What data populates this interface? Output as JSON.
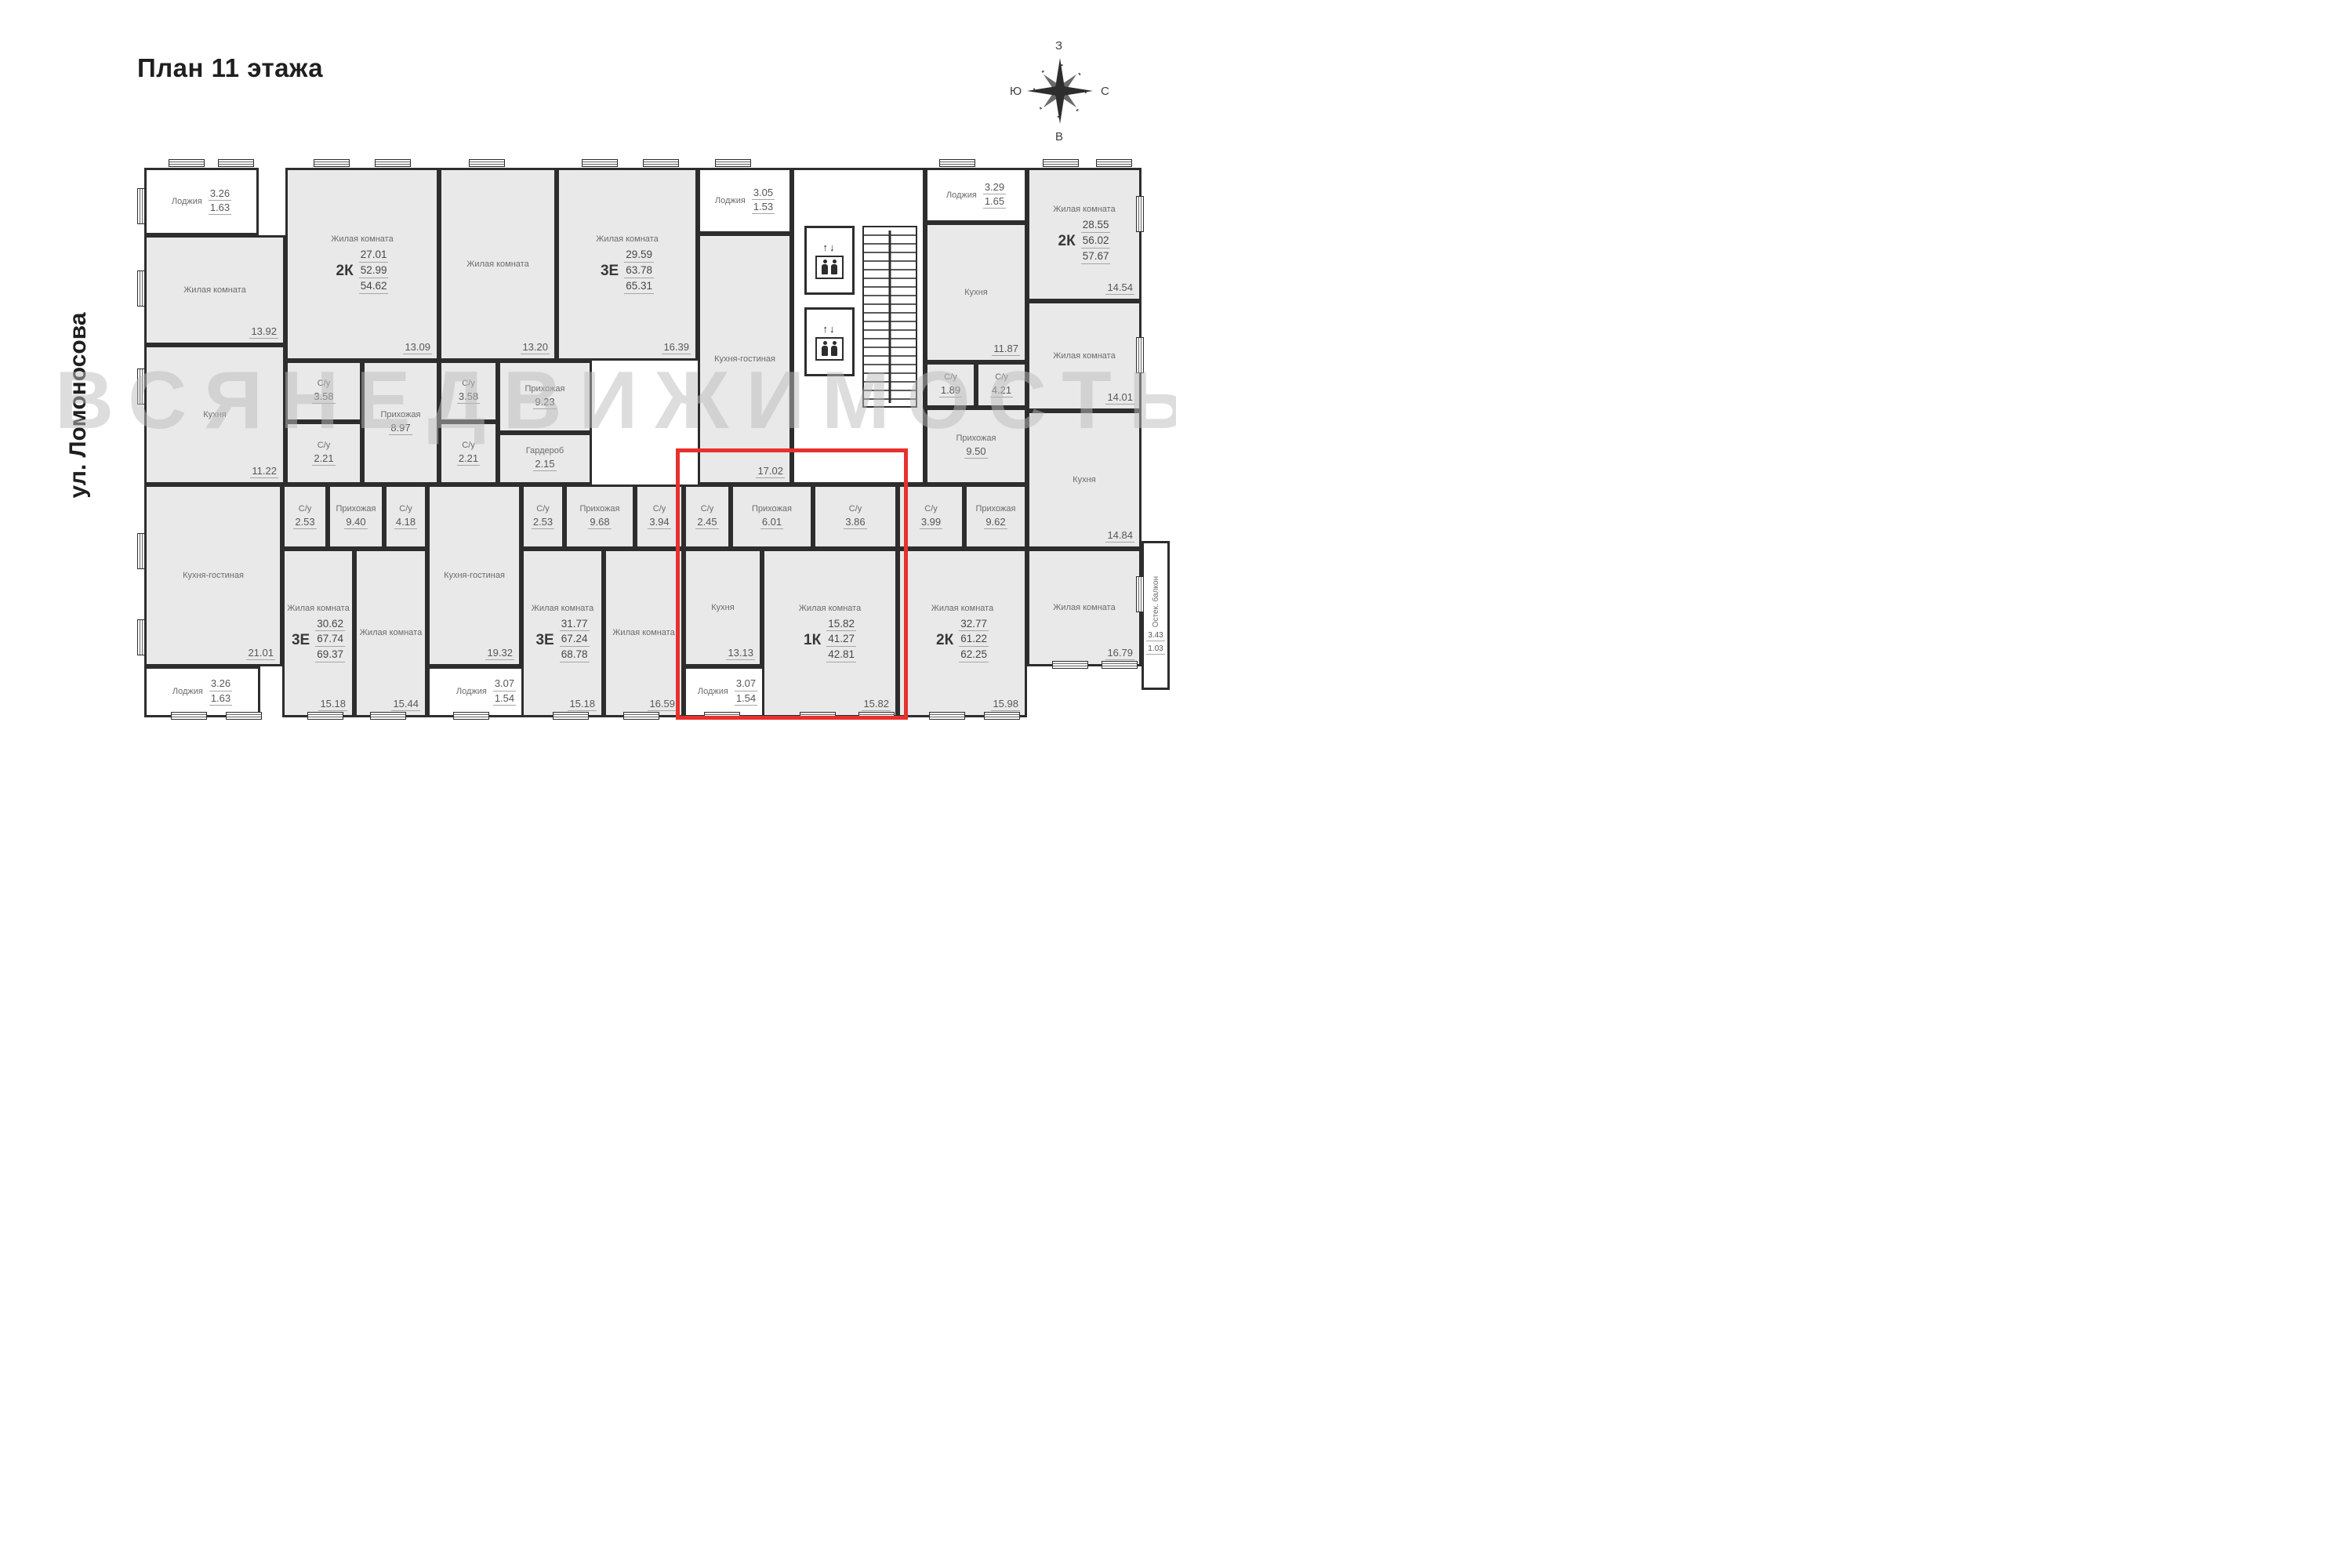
{
  "title": "План 11 этажа",
  "street": "ул. Ломоносова",
  "watermark": "ВСЯНЕДВИЖИМОСТЬ",
  "highlight_color": "#e8312e",
  "compass": {
    "top": "З",
    "right": "С",
    "bottom": "В",
    "left": "Ю"
  },
  "apartments": {
    "a": {
      "type": "2К",
      "living": "27.01",
      "area": "52.99",
      "total": "54.62",
      "rooms": {
        "loggia": {
          "name": "Лоджия",
          "a1": "3.26",
          "a2": "1.63"
        },
        "living1": {
          "name": "Жилая комната",
          "area": "13.92"
        },
        "kitchen": {
          "name": "Кухня",
          "area": "11.22"
        },
        "living2": {
          "name": "Жилая комната",
          "area": "13.09"
        },
        "bath1": {
          "name": "С/у",
          "area": "3.58"
        },
        "bath2": {
          "name": "С/у",
          "area": "2.21"
        },
        "hall": {
          "name": "Прихожая",
          "area": "8.97"
        }
      }
    },
    "b": {
      "type": "3Е",
      "living": "29.59",
      "area": "63.78",
      "total": "65.31",
      "rooms": {
        "living1": {
          "name": "Жилая комната",
          "area": "13.20"
        },
        "living2": {
          "name": "Жилая комната",
          "area": "16.39"
        },
        "bath1": {
          "name": "С/у",
          "area": "3.58"
        },
        "bath2": {
          "name": "С/у",
          "area": "2.21"
        },
        "hall": {
          "name": "Прихожая",
          "area": "9.23"
        },
        "wardrobe": {
          "name": "Гардероб",
          "area": "2.15"
        },
        "loggia": {
          "name": "Лоджия",
          "a1": "3.05",
          "a2": "1.53"
        },
        "kitchen": {
          "name": "Кухня-гостиная",
          "area": "17.02"
        }
      }
    },
    "d": {
      "type": "2К",
      "living": "28.55",
      "area": "56.02",
      "total": "57.67",
      "rooms": {
        "loggia": {
          "name": "Лоджия",
          "a1": "3.29",
          "a2": "1.65"
        },
        "kitchen": {
          "name": "Кухня",
          "area": "11.87"
        },
        "living1": {
          "name": "Жилая комната",
          "area": "14.54"
        },
        "living2": {
          "name": "Жилая комната",
          "area": "14.01"
        },
        "bath1": {
          "name": "С/у",
          "area": "1.89"
        },
        "bath2": {
          "name": "С/у",
          "area": "4.21"
        },
        "hall": {
          "name": "Прихожая",
          "area": "9.50"
        }
      }
    },
    "e": {
      "type": "3Е",
      "living": "30.62",
      "area": "67.74",
      "total": "69.37",
      "rooms": {
        "kitchen": {
          "name": "Кухня-гостиная",
          "area": "21.01"
        },
        "loggia": {
          "name": "Лоджия",
          "a1": "3.26",
          "a2": "1.63"
        },
        "bath1": {
          "name": "С/у",
          "area": "2.53"
        },
        "hall": {
          "name": "Прихожая",
          "area": "9.40"
        },
        "bath2": {
          "name": "С/у",
          "area": "4.18"
        },
        "living1": {
          "name": "Жилая комната",
          "area": "15.18"
        },
        "living2": {
          "name": "Жилая комната",
          "area": "15.44"
        }
      }
    },
    "f": {
      "type": "3Е",
      "living": "31.77",
      "area": "67.24",
      "total": "68.78",
      "rooms": {
        "kitchen": {
          "name": "Кухня-гостиная",
          "area": "19.32"
        },
        "loggia": {
          "name": "Лоджия",
          "a1": "3.07",
          "a2": "1.54"
        },
        "bath1": {
          "name": "С/у",
          "area": "2.53"
        },
        "hall": {
          "name": "Прихожая",
          "area": "9.68"
        },
        "bath2": {
          "name": "С/у",
          "area": "3.94"
        },
        "living1": {
          "name": "Жилая комната",
          "area": "15.18"
        },
        "living2": {
          "name": "Жилая комната",
          "area": "16.59"
        }
      }
    },
    "g": {
      "type": "1К",
      "living": "15.82",
      "area": "41.27",
      "total": "42.81",
      "highlighted": true,
      "rooms": {
        "bath1": {
          "name": "С/у",
          "area": "2.45"
        },
        "hall": {
          "name": "Прихожая",
          "area": "6.01"
        },
        "bath2": {
          "name": "С/у",
          "area": "3.86"
        },
        "kitchen": {
          "name": "Кухня",
          "area": "13.13"
        },
        "living1": {
          "name": "Жилая комната",
          "area": "15.82"
        },
        "loggia": {
          "name": "Лоджия",
          "a1": "3.07",
          "a2": "1.54"
        }
      }
    },
    "h": {
      "type": "2К",
      "living": "32.77",
      "area": "61.22",
      "total": "62.25",
      "rooms": {
        "hall": {
          "name": "Прихожая",
          "area": "9.62"
        },
        "bath1": {
          "name": "С/у",
          "area": "3.99"
        },
        "kitchen": {
          "name": "Кухня",
          "area": "14.84"
        },
        "living1": {
          "name": "Жилая комната",
          "area": "15.98"
        },
        "living2": {
          "name": "Жилая комната",
          "area": "16.79"
        },
        "balcony": {
          "name": "Остек. балкон",
          "a1": "3.43",
          "a2": "1.03"
        }
      }
    }
  }
}
